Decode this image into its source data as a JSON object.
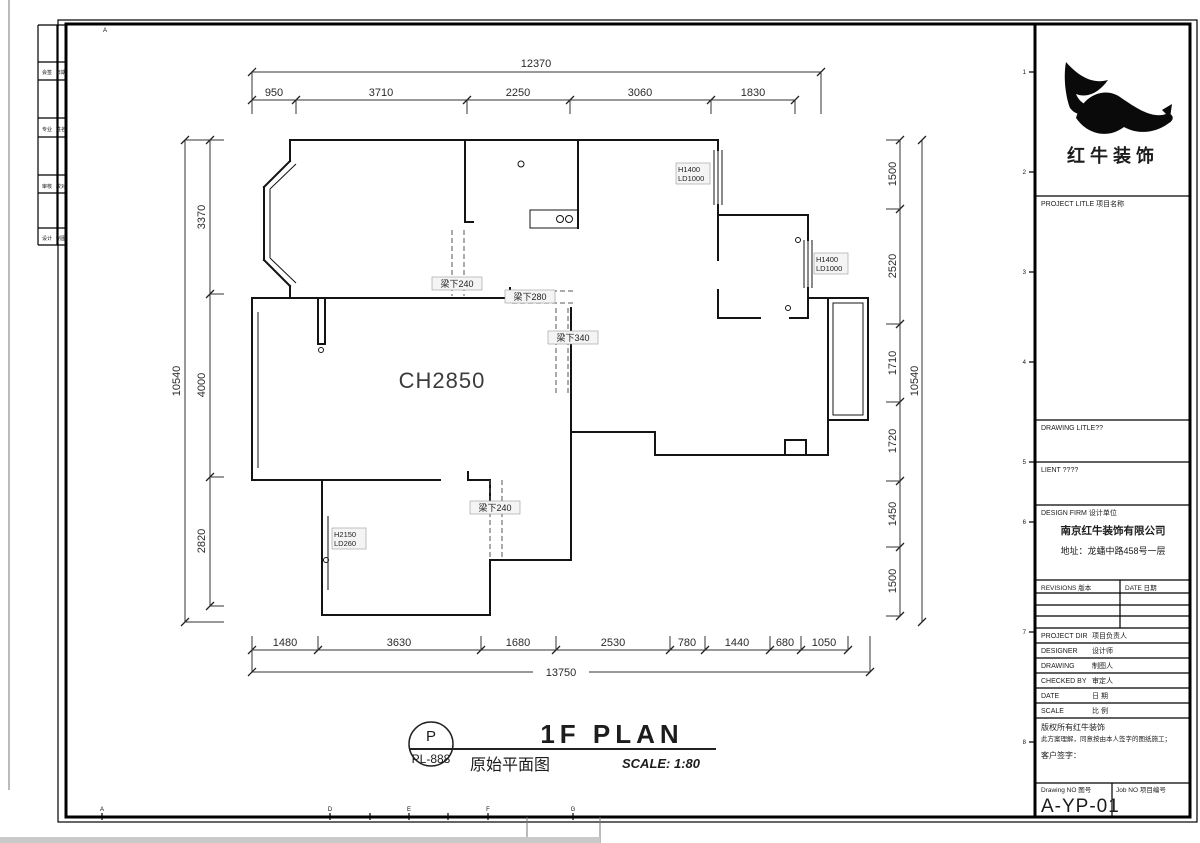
{
  "dims": {
    "top": {
      "overall": "12370",
      "segs": [
        "950",
        "3710",
        "2250",
        "3060",
        "1830"
      ]
    },
    "left": {
      "overall": "10540",
      "segs": [
        "3370",
        "4000",
        "2820"
      ]
    },
    "right": {
      "overall": "10540",
      "segs": [
        "1500",
        "2520",
        "1710",
        "1720",
        "1450",
        "1500"
      ]
    },
    "bottom": {
      "overall": "13750",
      "segs": [
        "1480",
        "3630",
        "1680",
        "2530",
        "780",
        "1440",
        "680",
        "1050"
      ]
    }
  },
  "plan": {
    "ceiling_height": "CH2850",
    "beams": [
      "梁下240",
      "梁下280",
      "梁下340",
      "梁下240"
    ],
    "tags": [
      {
        "a": "H1400",
        "b": "LD1000"
      },
      {
        "a": "H1400",
        "b": "LD1000"
      },
      {
        "a": "H2150",
        "b": "LD260"
      }
    ]
  },
  "stamp": {
    "letter": "P",
    "code": "PL-888"
  },
  "titlebar": {
    "title": "1F PLAN",
    "subtitle": "原始平面图",
    "scale": "SCALE: 1:80"
  },
  "tblock": {
    "brand": "红牛装饰",
    "project_title": "PROJECT LITLE 项目名称",
    "drawing_title": "DRAWING LITLE??",
    "client": "LIENT ????",
    "design_firm": "DESIGN FIRM 设计单位",
    "firm_name": "南京红牛装饰有限公司",
    "firm_address": "地址：龙蟠中路458号一层",
    "revisions": "REVISIONS 版本",
    "date_col": "DATE 日期",
    "rows": [
      {
        "en": "PROJECT DIR",
        "zh": "项目负责人"
      },
      {
        "en": "DESIGNER",
        "zh": "设计师"
      },
      {
        "en": "DRAWING",
        "zh": "制图人"
      },
      {
        "en": "CHECKED BY",
        "zh": "审定人"
      },
      {
        "en": "DATE",
        "zh": "日 期"
      },
      {
        "en": "SCALE",
        "zh": "比 例"
      }
    ],
    "copy1": "版权所有红牛装饰",
    "copy2": "此方案理解，同意按由本人签字的图纸施工；",
    "sign": "客户签字：",
    "drawing_no": "Drawing NO 图号",
    "job_no": "Job NO 项目编号",
    "sheet_no": "A-YP-01"
  },
  "frame": {
    "top_letters": [
      "A"
    ],
    "bottom_letters": [
      "A",
      "D",
      "E",
      "F",
      "G"
    ],
    "edge_numbers": [
      "1",
      "2",
      "3",
      "4",
      "5",
      "6",
      "7",
      "8"
    ],
    "strip": [
      [
        "会签",
        "日期"
      ],
      [
        "专业",
        "姓名"
      ],
      [
        "审核",
        "校对"
      ],
      [
        "设计",
        "制图"
      ]
    ]
  }
}
